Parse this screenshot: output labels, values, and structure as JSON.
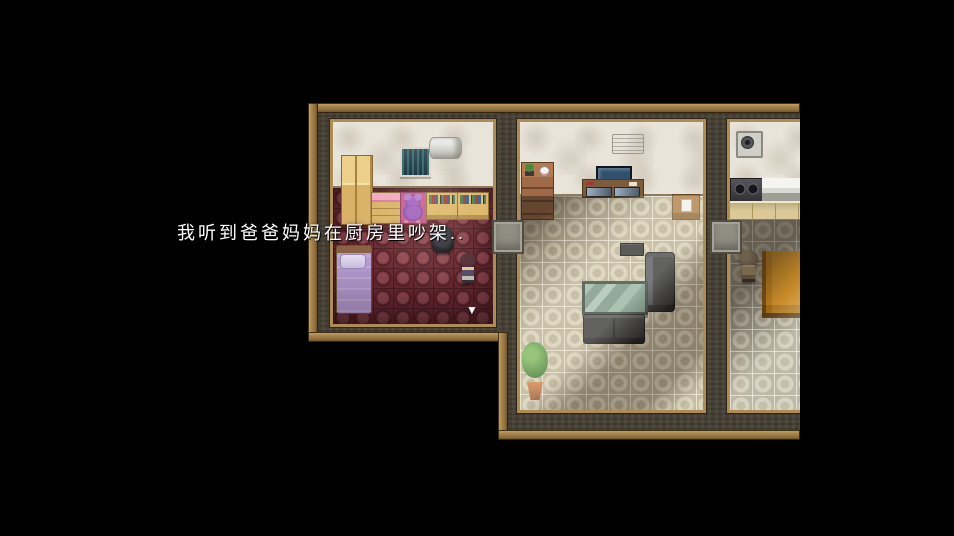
{
  "message": {
    "text": "我听到爸爸妈妈在厨房里吵架..",
    "continue_indicator": "▼"
  },
  "colors": {
    "bg": "#000000",
    "text": "#ffffff",
    "wood": "#a9854e",
    "wall-dark": "#474034",
    "wall-light": "#e9e4da",
    "room-frame": "#ae8d55",
    "floor-red": "#6b2a31",
    "floor-beige": "#b7ab90",
    "floor-gray": "#a29a8c"
  },
  "scene": {
    "rooms": [
      {
        "name": "bedroom",
        "floor": "dark-red-pattern",
        "objects": [
          "wardrobe",
          "pink-dresser",
          "teddy-bear",
          "bookshelf",
          "bookshelf",
          "window",
          "air-conditioner",
          "purple-bed",
          "desk-chair",
          "girl-character"
        ]
      },
      {
        "name": "living-room",
        "floor": "beige-tile",
        "objects": [
          "air-conditioner",
          "display-shelf-with-plant-and-clock",
          "tv-on-desk",
          "side-table",
          "stereo",
          "sofa",
          "glass-coffee-table",
          "sofa",
          "potted-plant"
        ]
      },
      {
        "name": "kitchen",
        "floor": "gray-tile",
        "objects": [
          "ventilation-fan",
          "stove",
          "kitchen-counter",
          "cabinets",
          "mother-character",
          "dining-table"
        ]
      }
    ]
  }
}
